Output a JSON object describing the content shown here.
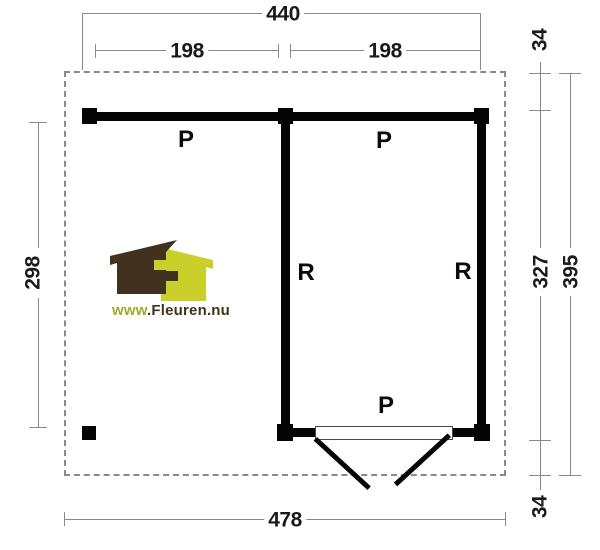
{
  "drawing": {
    "dimensions": {
      "total_width_top": "440",
      "bay_left": "198",
      "bay_right": "198",
      "overhang_top": "34",
      "room_depth": "327",
      "total_depth": "395",
      "overhang_bottom": "34",
      "open_side_depth": "298",
      "total_width_bottom": "478"
    },
    "room_labels": {
      "area_left": "P",
      "area_room": "P",
      "wall_left": "R",
      "wall_right": "R",
      "area_door": "P"
    },
    "colors": {
      "wall": "#050505",
      "dimension_line": "#8a8a8a",
      "dimension_text": "#1a1a1a",
      "boundary_dash": "#8a8a8a"
    }
  },
  "logo": {
    "text_green": "www",
    "text_brown": ".Fleuren.nu",
    "colors": {
      "house_brown": "#40321f",
      "house_lime": "#cad029",
      "text_green": "#9eab28",
      "text_brown": "#42331f"
    }
  }
}
